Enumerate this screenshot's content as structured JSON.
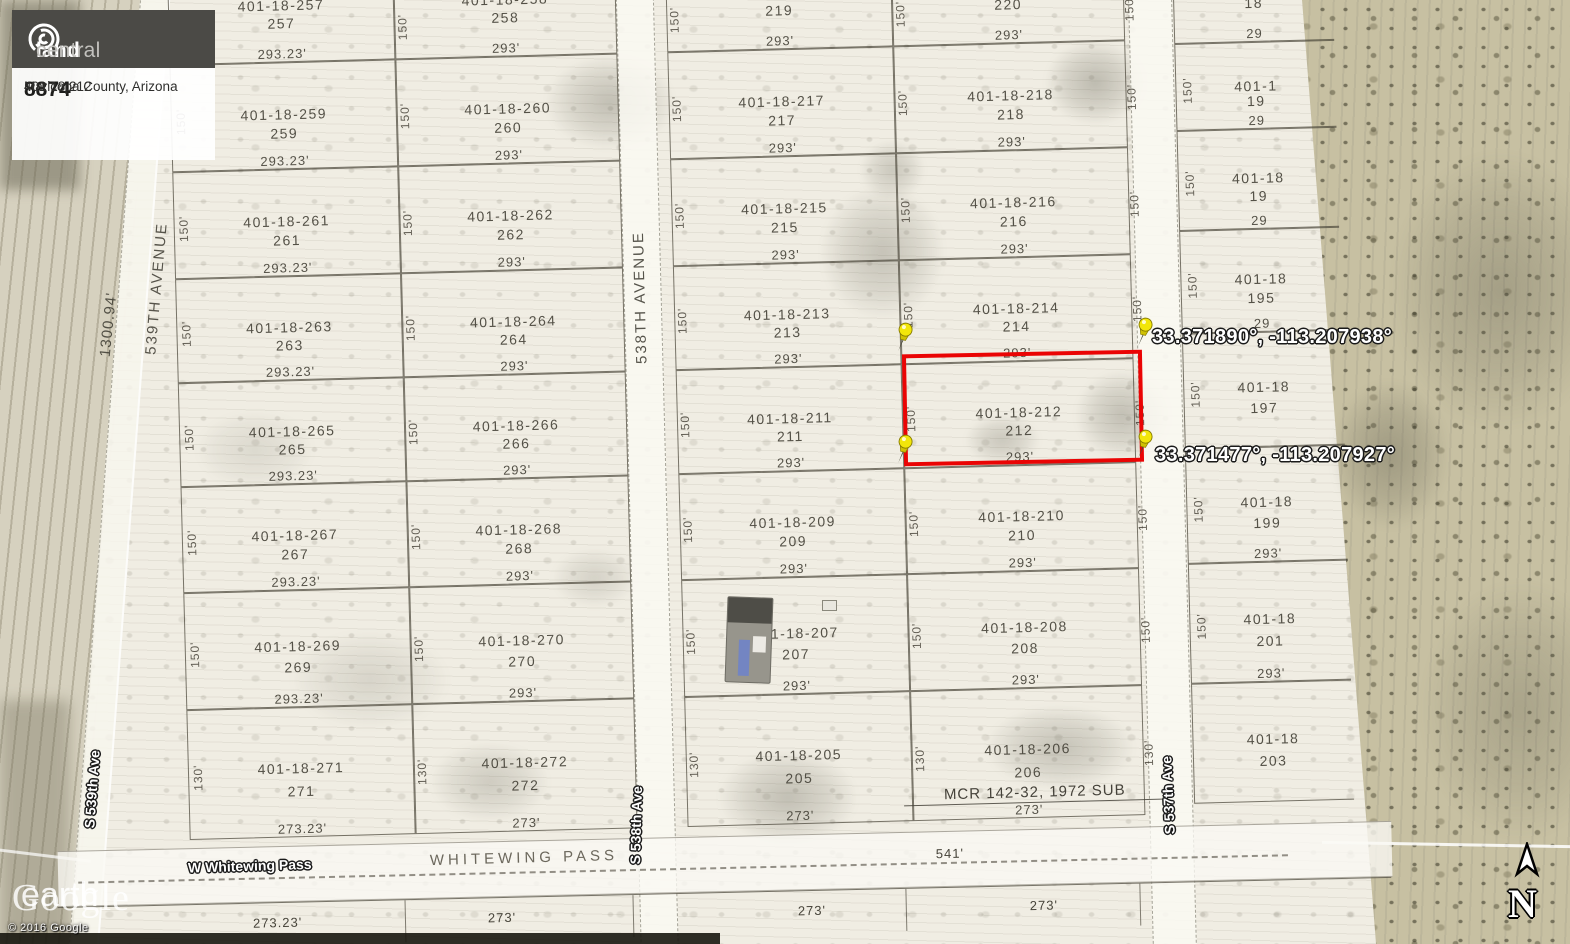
{
  "branding": {
    "logo_land": "land",
    "logo_central": "central",
    "listing_id": "8874",
    "location": "Maricopa County, Arizona",
    "apn": "401 18 212"
  },
  "watermark": {
    "brand": "Google",
    "product": "earth",
    "copyright": "© 2016 Google"
  },
  "compass": {
    "label": "N"
  },
  "highlight": {
    "apn": "401-18-212",
    "color": "#ea0404"
  },
  "pins": [
    {
      "id": "tl",
      "label": "33.371883°, -113.208899°"
    },
    {
      "id": "tr",
      "label": "33.371890°, -113.207938°"
    },
    {
      "id": "bl",
      "label": "33.371475°, -113.208899°"
    },
    {
      "id": "br",
      "label": "33.371477°, -113.207927°"
    }
  ],
  "roads": {
    "v_539_plat": "539TH AVENUE",
    "v_538_plat": "538TH AVENUE",
    "v_539_ge": "S 539th Ave",
    "v_538_ge": "S 538th Ave",
    "v_537_ge": "S 537th Ave",
    "h_ge": "W Whitewing Pass",
    "h_plat": "WHITEWING PASS",
    "h_dim": "541'"
  },
  "edge_dim": "1300.94'",
  "plat": {
    "side_dim": "150'",
    "side_dim_bottom": "130'",
    "bottom_dims": [
      "273.23'",
      "273'",
      "273'",
      "273'"
    ],
    "note": "MCR 142-32, 1972 SUB",
    "columns": [
      {
        "id": "A",
        "cells": [
          [
            "401-18-257",
            "257",
            "293.23'"
          ],
          [
            "401-18-259",
            "259",
            "293.23'"
          ],
          [
            "401-18-261",
            "261",
            "293.23'"
          ],
          [
            "401-18-263",
            "263",
            "293.23'"
          ],
          [
            "401-18-265",
            "265",
            "293.23'"
          ],
          [
            "401-18-267",
            "267",
            "293.23'"
          ],
          [
            "401-18-269",
            "269",
            "293.23'"
          ],
          [
            "401-18-271",
            "271",
            "273.23'"
          ]
        ]
      },
      {
        "id": "B",
        "cells": [
          [
            "401-18-258",
            "258",
            "293'"
          ],
          [
            "401-18-260",
            "260",
            "293'"
          ],
          [
            "401-18-262",
            "262",
            "293'"
          ],
          [
            "401-18-264",
            "264",
            "293'"
          ],
          [
            "401-18-266",
            "266",
            "293'"
          ],
          [
            "401-18-268",
            "268",
            "293'"
          ],
          [
            "401-18-270",
            "270",
            "293'"
          ],
          [
            "401-18-272",
            "272",
            "273'"
          ]
        ]
      },
      {
        "id": "C",
        "cells": [
          [
            "",
            "219",
            "293'"
          ],
          [
            "401-18-217",
            "217",
            "293'"
          ],
          [
            "401-18-215",
            "215",
            "293'"
          ],
          [
            "401-18-213",
            "213",
            "293'"
          ],
          [
            "401-18-211",
            "211",
            "293'"
          ],
          [
            "401-18-209",
            "209",
            "293'"
          ],
          [
            "401-18-207",
            "207",
            "293'"
          ],
          [
            "401-18-205",
            "205",
            "273'"
          ]
        ]
      },
      {
        "id": "D",
        "cells": [
          [
            "401-18-220",
            "220",
            "293'"
          ],
          [
            "401-18-218",
            "218",
            "293'"
          ],
          [
            "401-18-216",
            "216",
            "293'"
          ],
          [
            "401-18-214",
            "214",
            "293'"
          ],
          [
            "401-18-212",
            "212",
            "293'"
          ],
          [
            "401-18-210",
            "210",
            "293'"
          ],
          [
            "401-18-208",
            "208",
            "293'"
          ],
          [
            "401-18-206",
            "206",
            "273'"
          ]
        ]
      },
      {
        "id": "E",
        "cells": [
          [
            "",
            "18",
            "29"
          ],
          [
            "401-1",
            "19",
            "29"
          ],
          [
            "401-18",
            "19",
            "29"
          ],
          [
            "401-18",
            "195",
            "29"
          ],
          [
            "401-18",
            "197",
            ""
          ],
          [
            "401-18",
            "199",
            "293'"
          ],
          [
            "401-18",
            "201",
            "293'"
          ],
          [
            "401-18",
            "203",
            ""
          ]
        ]
      }
    ]
  }
}
